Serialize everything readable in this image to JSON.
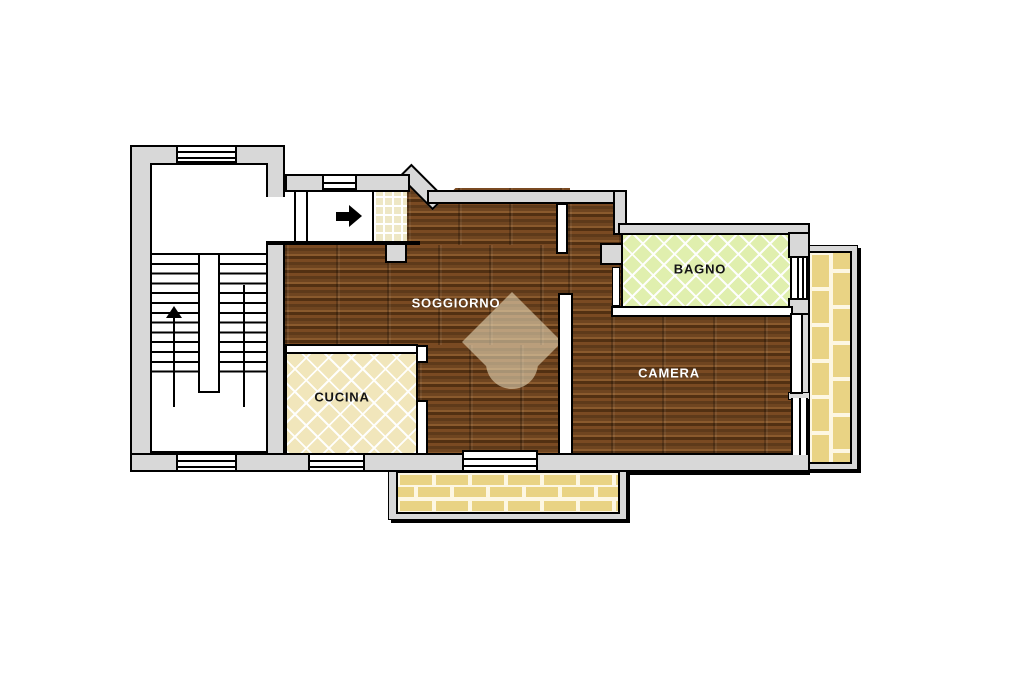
{
  "floorplan": {
    "type": "apartment-floor-plan",
    "rooms": {
      "soggiorno": {
        "label": "SOGGIORNO",
        "floor": "dark-wood-parquet",
        "label_color": "#ffffff"
      },
      "cucina": {
        "label": "CUCINA",
        "floor": "beige-diamond-tile",
        "label_color": "#141414"
      },
      "bagno": {
        "label": "BAGNO",
        "floor": "green-diamond-tile",
        "label_color": "#141414"
      },
      "camera": {
        "label": "CAMERA",
        "floor": "dark-wood-parquet",
        "label_color": "#ffffff"
      }
    },
    "features": {
      "stairwell": "double-flight-stairs-with-up-arrow",
      "entrance": "corridor-with-right-arrow-and-small-grid-tile-vestibule",
      "balcony_right": "vertical-brick-paved",
      "balcony_bottom": "horizontal-brick-paved",
      "windows": [
        "stairwell-top",
        "stairwell-bottom",
        "entrance-top",
        "cucina-bottom",
        "soggiorno-french-door",
        "bagno-to-balcony",
        "camera-balcony-door"
      ]
    },
    "icons": {
      "entrance_arrow": "right-arrow",
      "stairs_direction_arrow": "up-arrow",
      "watermark": "house-logo"
    },
    "colors": {
      "wall_gray": "#d8d8d8",
      "outline_black": "#000000",
      "wood_base": "#6b4420",
      "kitchen_tile": "#f1e6bb",
      "bath_tile": "#e0efae",
      "entry_tile": "#eee7c5",
      "balcony_brick": "#e9d384",
      "brick_mortar": "#fdf7e3",
      "watermark_fill": "#efe4c4"
    }
  }
}
